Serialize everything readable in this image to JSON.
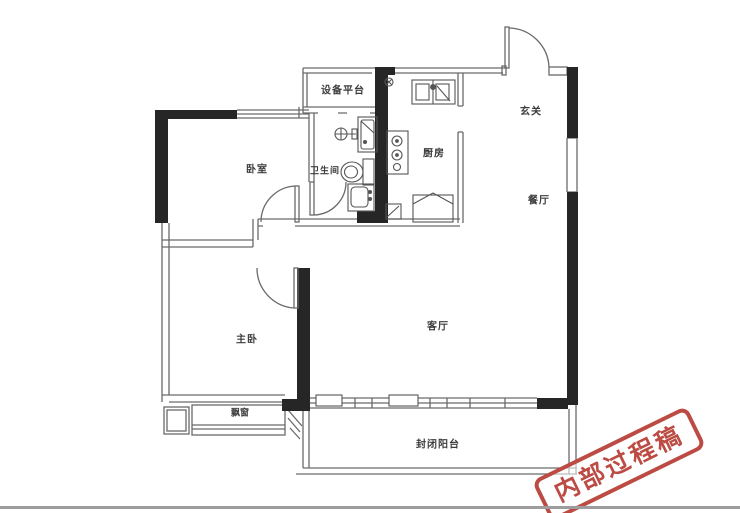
{
  "meta": {
    "type": "apartment-floor-plan",
    "description": "2-bedroom apartment floor plan with enclosed balcony"
  },
  "rooms": {
    "equipment_platform": {
      "label": "设备平台"
    },
    "entry": {
      "label": "玄关"
    },
    "bedroom": {
      "label": "卧室"
    },
    "bathroom": {
      "label": "卫生间"
    },
    "kitchen": {
      "label": "厨房"
    },
    "dining": {
      "label": "餐厅"
    },
    "master_bedroom": {
      "label": "主卧"
    },
    "living_room": {
      "label": "客厅"
    },
    "bay_window": {
      "label": "飘窗"
    },
    "balcony": {
      "label": "封闭阳台"
    }
  },
  "stamp": {
    "text": "内部过程稿",
    "color": "#bc4b43"
  },
  "colors": {
    "wall_black": "#262626",
    "thin_line": "#6a6a6a",
    "background": "#ffffff",
    "photo_edge": "#9d9d9d"
  }
}
